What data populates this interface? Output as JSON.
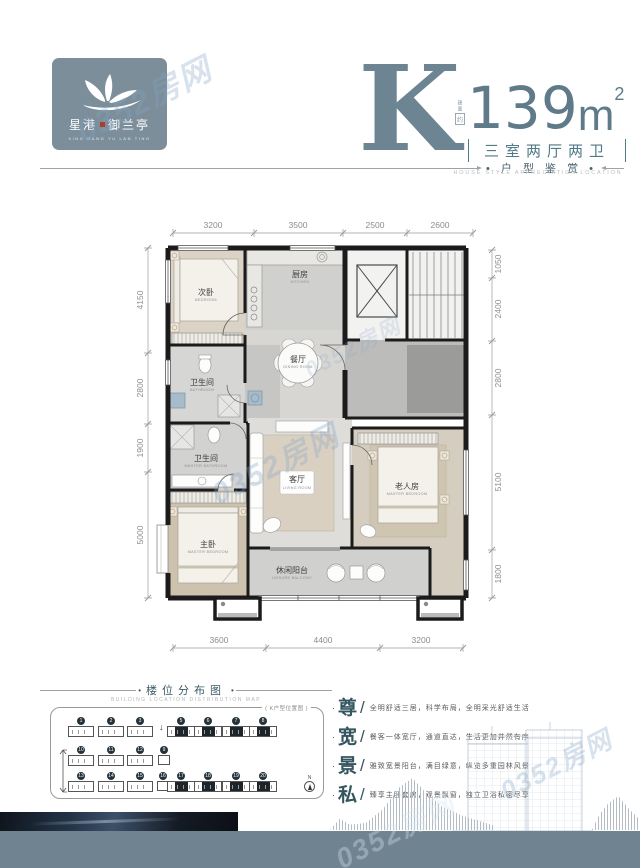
{
  "watermark_text": "0352房网",
  "logo": {
    "name_left": "星港",
    "name_right": "御兰亭",
    "en": "XING GANG YU LAN TING"
  },
  "header": {
    "type_letter": "K",
    "area_prefix_top": "建面",
    "area_prefix_box": "约",
    "area_value": "139",
    "area_unit": "m",
    "area_exp": "2",
    "rooms_text": "三室两厅两卫",
    "section_dot": "•",
    "section_cn": "户 型 鉴 赏",
    "section_en": "HOUSE STYLE APPRECIATION LOCATION"
  },
  "plan": {
    "dims_top": [
      "3200",
      "3500",
      "2500",
      "2600"
    ],
    "dims_left": [
      "4150",
      "2800",
      "1900",
      "5000"
    ],
    "dims_right": [
      "1050",
      "2400",
      "2800",
      "5100",
      "1800"
    ],
    "dims_bottom": [
      "3600",
      "4400",
      "3200"
    ],
    "rooms": {
      "bedroom2": {
        "cn": "次卧",
        "en": "BEDROOM"
      },
      "bath1": {
        "cn": "卫生间",
        "en": "BATHROOM"
      },
      "kitchen": {
        "cn": "厨房",
        "en": "KITCHEN"
      },
      "dining": {
        "cn": "餐厅",
        "en": "DINING ROOM"
      },
      "living": {
        "cn": "客厅",
        "en": "LIVING ROOM"
      },
      "master_bath": {
        "cn": "卫生间",
        "en": "MASTER BATHROOM"
      },
      "master": {
        "cn": "主卧",
        "en": "MASTER BEDROOM"
      },
      "elder": {
        "cn": "老人房",
        "en": "MASTER BEDROOM"
      },
      "balcony": {
        "cn": "休闲阳台",
        "en": "LEISURE BALCONY"
      }
    }
  },
  "location_map": {
    "bullet": "•",
    "title_cn": "楼位分布图",
    "title_en": "BUILDING LOCATION DISTRIBUTION MAP",
    "legend": "( K户型位置图 )",
    "entry_arrow": "↓",
    "north": "N",
    "buildings": [
      {
        "no": "1"
      },
      {
        "no": "2"
      },
      {
        "no": "3"
      },
      {
        "no": "5"
      },
      {
        "no": "6"
      },
      {
        "no": "7"
      },
      {
        "no": "8"
      },
      {
        "no": "10"
      },
      {
        "no": "11"
      },
      {
        "no": "12"
      },
      {
        "no": "9"
      },
      {
        "no": "13"
      },
      {
        "no": "14"
      },
      {
        "no": "15"
      },
      {
        "no": "16"
      },
      {
        "no": "17"
      },
      {
        "no": "18"
      },
      {
        "no": "19"
      },
      {
        "no": "20"
      }
    ]
  },
  "feature_sep": "/",
  "feature_bullet": "·",
  "features": [
    {
      "key": "尊",
      "text": "全明舒适三居，科学布局，全明采光舒适生活"
    },
    {
      "key": "宽",
      "text": "餐客一体宽厅，通道直达，生活更加井然有序"
    },
    {
      "key": "景",
      "text": "雅致宽景阳台，满目绿意，纵览多重园林风景"
    },
    {
      "key": "私",
      "text": "臻享主卧套房，观景飘窗，独立卫浴私密尽享"
    }
  ]
}
